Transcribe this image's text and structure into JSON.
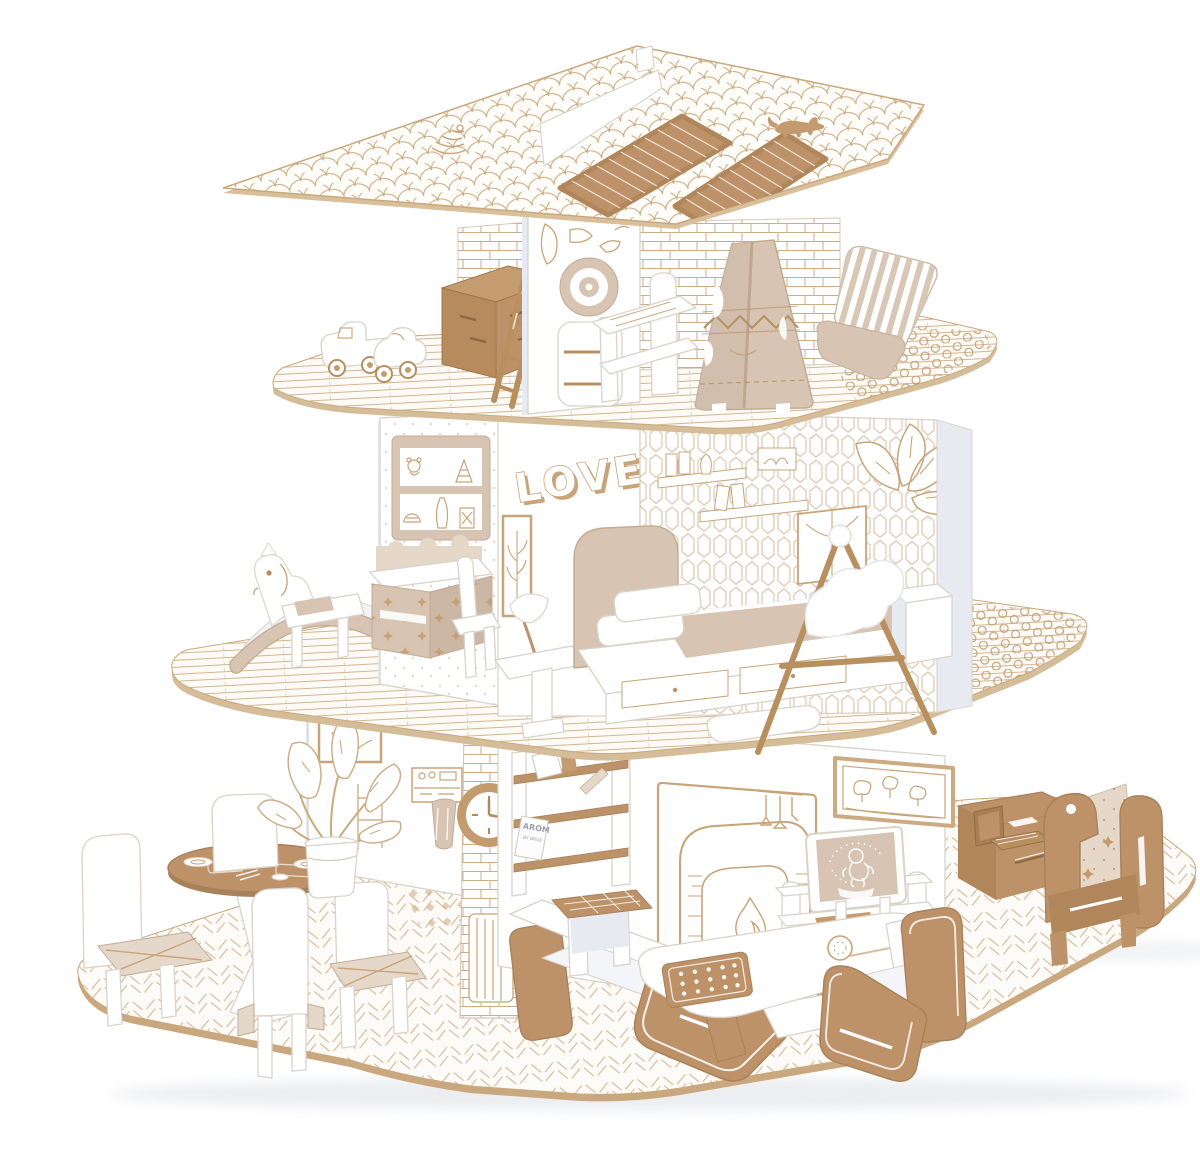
{
  "image": {
    "type": "product-photo",
    "subject": "Three-storey white cardboard dollhouse construction set with cut-out kraft cardboard furniture on a white background"
  },
  "palette": {
    "kraft": "#bd9268",
    "kraft-deep": "#aa8259",
    "kraft-face": "#b2865b",
    "beige": "#d7c4b2",
    "beige-soft": "#e5d8c9",
    "line-tan": "#c8a478",
    "floor-line": "#d3b68e",
    "panel-edge": "#d9d3c9",
    "panel-shadow": "#e8eaf1",
    "slab-edge": "#cfae85"
  },
  "labels": {
    "wall_art": "LOVE",
    "book_title": "AROM",
    "book_subtitle": "BY BRUE"
  },
  "roof": {
    "finish": "fish-scale shingle print",
    "solar_panels": 2,
    "decor": [
      "cat-silhouette",
      "bird-nest-print",
      "white-ridge-fin"
    ]
  },
  "floors": [
    {
      "name": "top-floor",
      "theme": "kids room and roof terrace",
      "items": [
        "toy-truck",
        "toy-car",
        "kraft-toy-chest",
        "ladder",
        "porthole-wall",
        "step-stool",
        "shelf-bench",
        "teepee-tent",
        "striped-lounge-chair",
        "brick-walls",
        "pebble-terrace"
      ]
    },
    {
      "name": "middle-floor",
      "theme": "bedroom and studio",
      "items": [
        "rocking-horse",
        "star-desk",
        "desk-chair",
        "toy-shelf-wall-print",
        "love-wall",
        "framed-botanical-print",
        "honeycomb-wallpaper",
        "leaf-wall-print",
        "bed-with-drawers",
        "pillows",
        "blanket",
        "nightstand-with-lamp",
        "easel",
        "white-cabinet",
        "pebble-terrace"
      ]
    },
    {
      "name": "ground-floor",
      "theme": "living and dining room",
      "items": [
        "round-dining-table",
        "dining-chairs",
        "potted-plant",
        "kitchen-wall-print",
        "hanging-towel",
        "chimney-clock",
        "radiator",
        "bookshelf",
        "books",
        "fireplace-wall-print",
        "window-wall-print",
        "tv-with-monkey-cartoon",
        "tv-stand",
        "sofa",
        "coffee-table",
        "checkerboard-game",
        "woven-stool",
        "armchair",
        "writing-desk",
        "cardboard-laptop",
        "star-armchair",
        "herringbone-rug-floor"
      ]
    }
  ]
}
